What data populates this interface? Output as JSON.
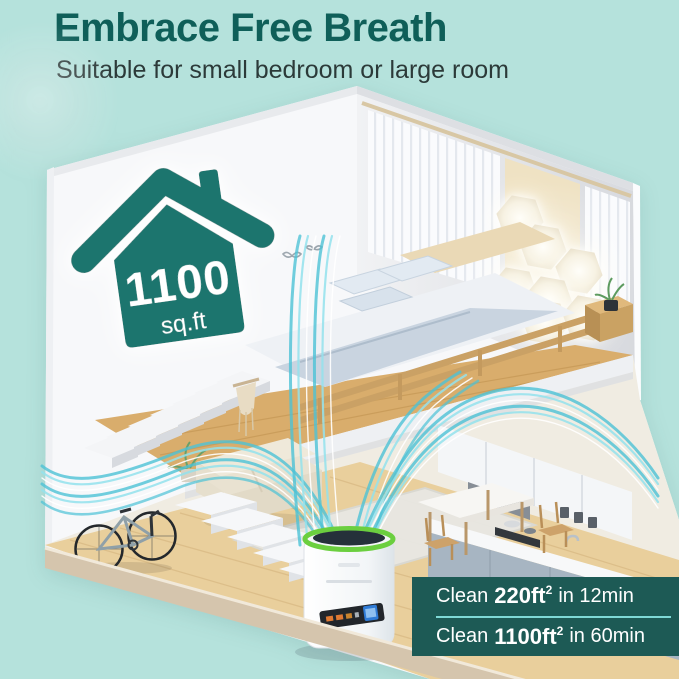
{
  "colors": {
    "background": "#b5e2dc",
    "title_teal": "#0f5f59",
    "subtitle_gray": "#2c3a39",
    "house_icon_teal": "#1e756e",
    "panel_teal": "#1d5a55",
    "panel_divider_cyan": "#7fd9d6",
    "panel_text": "#ffffff",
    "airflow_cyan": "#4cc2d6",
    "purifier_ring_green": "#6bcf3f",
    "wood_floor": "#e9cf9c"
  },
  "header": {
    "title": "Embrace Free Breath",
    "subtitle": "Suitable for small bedroom or large room"
  },
  "coverage_badge": {
    "icon": "house-icon",
    "value": "1100",
    "unit": "sq.ft"
  },
  "performance_panel": {
    "rows": [
      {
        "prefix": "Clean",
        "area": "220ft",
        "sup": "2",
        "suffix": "in 12min"
      },
      {
        "prefix": "Clean",
        "area": "1100ft",
        "sup": "2",
        "suffix": "in 60min"
      }
    ]
  },
  "scene": {
    "kind": "isometric-room-cutaway",
    "elements": [
      "loft-bedroom",
      "bed",
      "curtains",
      "hexagon-wall-lights",
      "staircase-upper",
      "staircase-lower",
      "macrame-hanging",
      "sofa",
      "rug",
      "bicycle",
      "kitchen",
      "dining-table",
      "air-purifier",
      "clean-air-streams",
      "house-coverage-icon"
    ]
  }
}
